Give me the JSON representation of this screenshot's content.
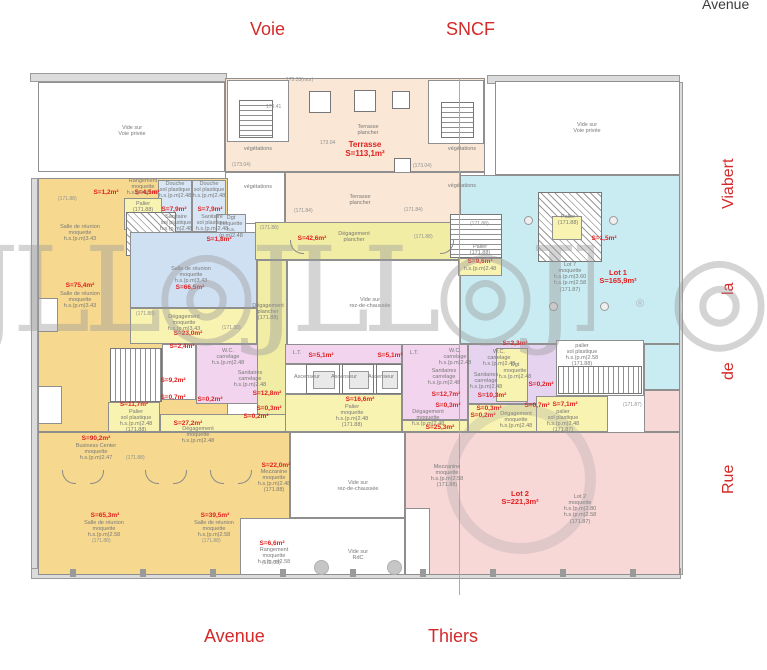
{
  "colors": {
    "accent_red": "#e01f1f",
    "street_red": "#d42a2a",
    "orange": "#f6d98e",
    "yellow": "#f8f3b0",
    "corridor_yellow": "#f1eda4",
    "blue": "#cfe0f3",
    "cyan": "#c9ecf2",
    "pink_lot2": "#f8d7d7",
    "magenta_sanitary": "#f2d4ee",
    "terrace_peach": "#fae7d5",
    "wall_gray": "#8f8f8f"
  },
  "streets": {
    "top_left": "Voie",
    "top_right": "SNCF",
    "top_far_right": "Avenue",
    "bottom_left": "Avenue",
    "bottom_right": "Thiers",
    "side_words": {
      "w1": "Viabert",
      "w2": "la",
      "w3": "de",
      "w4": "Rue"
    }
  },
  "watermark": {
    "row": "JLL◎JLL◎JLL◎",
    "fragment": "◎",
    "registered": "®"
  },
  "plan": {
    "area_labels": [
      {
        "lines": [
          "Terrasse",
          "S=113,1m²"
        ],
        "x": 335,
        "y": 141,
        "w": 60,
        "size": 8
      },
      {
        "lines": [
          "S=1,2m²"
        ],
        "x": 90,
        "y": 189,
        "w": 32
      },
      {
        "lines": [
          "S=4,5m²"
        ],
        "x": 131,
        "y": 189,
        "w": 32
      },
      {
        "lines": [
          "S=7,9m²"
        ],
        "x": 158,
        "y": 206,
        "w": 32
      },
      {
        "lines": [
          "S=7,9m²"
        ],
        "x": 194,
        "y": 206,
        "w": 32
      },
      {
        "lines": [
          "S=1,8m²"
        ],
        "x": 203,
        "y": 236,
        "w": 32
      },
      {
        "lines": [
          "S=66,5m²"
        ],
        "x": 168,
        "y": 284,
        "w": 44
      },
      {
        "lines": [
          "S=75,4m²"
        ],
        "x": 60,
        "y": 282,
        "w": 40
      },
      {
        "lines": [
          "S=42,6m²"
        ],
        "x": 292,
        "y": 235,
        "w": 40
      },
      {
        "lines": [
          "S=1,5m²"
        ],
        "x": 588,
        "y": 235,
        "w": 32
      },
      {
        "lines": [
          "Lot 1",
          "S=165,9m²"
        ],
        "x": 592,
        "y": 269,
        "w": 52,
        "size": 7.5
      },
      {
        "lines": [
          "S=9,6m²"
        ],
        "x": 462,
        "y": 258,
        "w": 36
      },
      {
        "lines": [
          "S=23,0m²"
        ],
        "x": 168,
        "y": 330,
        "w": 40
      },
      {
        "lines": [
          "S=2,4m²"
        ],
        "x": 166,
        "y": 343,
        "w": 32
      },
      {
        "lines": [
          "S=9,2m²"
        ],
        "x": 157,
        "y": 377,
        "w": 32
      },
      {
        "lines": [
          "S=0,7m²"
        ],
        "x": 157,
        "y": 394,
        "w": 32
      },
      {
        "lines": [
          "S=0,2m²"
        ],
        "x": 194,
        "y": 396,
        "w": 32
      },
      {
        "lines": [
          "S=12,8m²"
        ],
        "x": 247,
        "y": 390,
        "w": 40
      },
      {
        "lines": [
          "S=11,7m²"
        ],
        "x": 112,
        "y": 401,
        "w": 44
      },
      {
        "lines": [
          "S=27,2m²"
        ],
        "x": 166,
        "y": 420,
        "w": 44
      },
      {
        "lines": [
          "S=0,3m²"
        ],
        "x": 253,
        "y": 405,
        "w": 32
      },
      {
        "lines": [
          "S=0,2m²"
        ],
        "x": 240,
        "y": 413,
        "w": 32
      },
      {
        "lines": [
          "S=5,1m²"
        ],
        "x": 305,
        "y": 352,
        "w": 32
      },
      {
        "lines": [
          "S=5,1m²"
        ],
        "x": 374,
        "y": 352,
        "w": 32
      },
      {
        "lines": [
          "S=16,6m²"
        ],
        "x": 338,
        "y": 396,
        "w": 44
      },
      {
        "lines": [
          "S=12,7m²"
        ],
        "x": 424,
        "y": 391,
        "w": 44
      },
      {
        "lines": [
          "S=0,3m²"
        ],
        "x": 432,
        "y": 402,
        "w": 32
      },
      {
        "lines": [
          "S=25,3m²"
        ],
        "x": 418,
        "y": 424,
        "w": 44
      },
      {
        "lines": [
          "S=2,3m²"
        ],
        "x": 499,
        "y": 340,
        "w": 32
      },
      {
        "lines": [
          "S=10,3m²"
        ],
        "x": 470,
        "y": 392,
        "w": 44
      },
      {
        "lines": [
          "S=0,2m²"
        ],
        "x": 525,
        "y": 381,
        "w": 32
      },
      {
        "lines": [
          "S=0,7m²"
        ],
        "x": 521,
        "y": 402,
        "w": 32
      },
      {
        "lines": [
          "S=0,3m²"
        ],
        "x": 473,
        "y": 405,
        "w": 32
      },
      {
        "lines": [
          "S=0,2m²"
        ],
        "x": 467,
        "y": 412,
        "w": 32
      },
      {
        "lines": [
          "S=7,1m²"
        ],
        "x": 549,
        "y": 401,
        "w": 32
      },
      {
        "lines": [
          "S=90,2m²"
        ],
        "x": 74,
        "y": 435,
        "w": 44
      },
      {
        "lines": [
          "S=65,3m²"
        ],
        "x": 83,
        "y": 512,
        "w": 44
      },
      {
        "lines": [
          "S=39,5m²"
        ],
        "x": 193,
        "y": 512,
        "w": 44
      },
      {
        "lines": [
          "S=6,6m²"
        ],
        "x": 254,
        "y": 540,
        "w": 36
      },
      {
        "lines": [
          "S=22,0m²"
        ],
        "x": 254,
        "y": 462,
        "w": 44
      },
      {
        "lines": [
          "Lot 2",
          "S=221,3m²"
        ],
        "x": 492,
        "y": 490,
        "w": 56,
        "size": 7.5
      }
    ],
    "name_labels": [
      {
        "lines": [
          "Vide sur",
          "Voie privée"
        ],
        "x": 100,
        "y": 125,
        "w": 64
      },
      {
        "lines": [
          "Vide sur",
          "Voie privée"
        ],
        "x": 555,
        "y": 122,
        "w": 64
      },
      {
        "lines": [
          "Terrasse",
          "plancher"
        ],
        "x": 346,
        "y": 124,
        "w": 44
      },
      {
        "lines": [
          "végétations"
        ],
        "x": 238,
        "y": 146,
        "w": 40
      },
      {
        "lines": [
          "végétations"
        ],
        "x": 442,
        "y": 146,
        "w": 40
      },
      {
        "lines": [
          "végétations"
        ],
        "x": 238,
        "y": 184,
        "w": 40
      },
      {
        "lines": [
          "végétations"
        ],
        "x": 442,
        "y": 183,
        "w": 40
      },
      {
        "lines": [
          "Terrasse",
          "plancher"
        ],
        "x": 338,
        "y": 194,
        "w": 44
      },
      {
        "lines": [
          "Rangement",
          "moquette",
          "h.s.(p.m)2.67"
        ],
        "x": 122,
        "y": 178,
        "w": 42
      },
      {
        "lines": [
          "Douche",
          "sol plastique",
          "h.s.(p.m)2.48"
        ],
        "x": 157,
        "y": 181,
        "w": 36
      },
      {
        "lines": [
          "Douche",
          "sol plastique",
          "h.s.(p.m)2.48"
        ],
        "x": 191,
        "y": 181,
        "w": 36
      },
      {
        "lines": [
          "Sanitaire",
          "sol plastique",
          "h.s.(p.m)2.48"
        ],
        "x": 158,
        "y": 214,
        "w": 36
      },
      {
        "lines": [
          "Sanitaire",
          "sol plastique",
          "h.s.(p.m)2.48"
        ],
        "x": 194,
        "y": 214,
        "w": 36
      },
      {
        "lines": [
          "Palier",
          "(171.88)"
        ],
        "x": 128,
        "y": 201,
        "w": 30
      },
      {
        "lines": [
          "Dgt",
          "moquette",
          "h.s.(p.m)2.48"
        ],
        "x": 215,
        "y": 215,
        "w": 32
      },
      {
        "lines": [
          "Salle de réunion",
          "moquette",
          "h.s.(p.m)3.43"
        ],
        "x": 50,
        "y": 224,
        "w": 60
      },
      {
        "lines": [
          "Salle de réunion",
          "moquette",
          "h.s.(p.m)3.43"
        ],
        "x": 50,
        "y": 291,
        "w": 60
      },
      {
        "lines": [
          "Salle de réunion",
          "moquette",
          "h.s.(p.m)3.43"
        ],
        "x": 162,
        "y": 266,
        "w": 58
      },
      {
        "lines": [
          "Dégagement",
          "plancher"
        ],
        "x": 328,
        "y": 231,
        "w": 52
      },
      {
        "lines": [
          "Dégagement",
          "plancher",
          "(171.88)"
        ],
        "x": 248,
        "y": 303,
        "w": 40
      },
      {
        "lines": [
          "Vide sur",
          "rez-de-chaussée"
        ],
        "x": 342,
        "y": 297,
        "w": 56
      },
      {
        "lines": [
          "Lot 7",
          "moquette",
          "h.s.(p.m)3.60",
          "h.s.(p.m)2.58",
          "(171.87)"
        ],
        "x": 548,
        "y": 262,
        "w": 44
      },
      {
        "lines": [
          "Palier",
          "(171.88)"
        ],
        "x": 552,
        "y": 214,
        "w": 32
      },
      {
        "lines": [
          "Palier",
          "(171.88)"
        ],
        "x": 460,
        "y": 244,
        "w": 40
      },
      {
        "lines": [
          "h.s.(p.m)2.48"
        ],
        "x": 460,
        "y": 266,
        "w": 40
      },
      {
        "lines": [
          "Dégagement",
          "moquette",
          "h.s.(p.m)3.43"
        ],
        "x": 158,
        "y": 314,
        "w": 52
      },
      {
        "lines": [
          "W.C.",
          "carrelage",
          "h.s.(p.m)2.48"
        ],
        "x": 210,
        "y": 348,
        "w": 36
      },
      {
        "lines": [
          "Sanitaires",
          "carrelage",
          "h.s.(p.m)2.48"
        ],
        "x": 228,
        "y": 370,
        "w": 44
      },
      {
        "lines": [
          "W.C.",
          "carrelage",
          "h.s.(p.m)2.48"
        ],
        "x": 437,
        "y": 348,
        "w": 36
      },
      {
        "lines": [
          "Sanitaires",
          "carrelage",
          "h.s.(p.m)2.48"
        ],
        "x": 422,
        "y": 368,
        "w": 44
      },
      {
        "lines": [
          "W.C.",
          "carrelage",
          "h.s.(p.m)2.48"
        ],
        "x": 481,
        "y": 349,
        "w": 36
      },
      {
        "lines": [
          "Sanitaires",
          "carrelage",
          "h.s.(p.m)2.48"
        ],
        "x": 464,
        "y": 372,
        "w": 44
      },
      {
        "lines": [
          "Palier",
          "sol plastique",
          "h.s.(p.m)2.48",
          "(171.88)"
        ],
        "x": 112,
        "y": 409,
        "w": 48
      },
      {
        "lines": [
          "Dégagement",
          "moquette",
          "h.s.(p.m)2.48"
        ],
        "x": 176,
        "y": 426,
        "w": 44
      },
      {
        "lines": [
          "Ascenseur"
        ],
        "x": 288,
        "y": 374,
        "w": 38
      },
      {
        "lines": [
          "Ascenseur"
        ],
        "x": 325,
        "y": 374,
        "w": 38
      },
      {
        "lines": [
          "Ascenseur"
        ],
        "x": 362,
        "y": 374,
        "w": 38
      },
      {
        "lines": [
          "L.T."
        ],
        "x": 288,
        "y": 350,
        "w": 18
      },
      {
        "lines": [
          "L.T."
        ],
        "x": 405,
        "y": 350,
        "w": 18
      },
      {
        "lines": [
          "Palier",
          "moquette",
          "h.s.(p.m)2.48",
          "(171.88)"
        ],
        "x": 328,
        "y": 404,
        "w": 48
      },
      {
        "lines": [
          "Dgt",
          "moquette",
          "h.s.(p.m)2.48"
        ],
        "x": 498,
        "y": 362,
        "w": 34
      },
      {
        "lines": [
          "Dégagement",
          "moquette",
          "h.s.(p.m)2.48"
        ],
        "x": 492,
        "y": 411,
        "w": 48
      },
      {
        "lines": [
          "Dégagement",
          "moquette",
          "h.s.(p.m)2.48"
        ],
        "x": 404,
        "y": 409,
        "w": 48
      },
      {
        "lines": [
          "palier",
          "sol plastique",
          "h.s.(p.m)2.58",
          "(171.88)"
        ],
        "x": 560,
        "y": 343,
        "w": 44
      },
      {
        "lines": [
          "palier",
          "sol plastique",
          "h.s.(p.m)2.48",
          "(171.87)"
        ],
        "x": 541,
        "y": 409,
        "w": 44
      },
      {
        "lines": [
          "Business Center",
          "moquette",
          "h.s.(p.m)2.47"
        ],
        "x": 64,
        "y": 443,
        "w": 64
      },
      {
        "lines": [
          "Salle de réunion",
          "moquette",
          "h.s.(p.m)2.58"
        ],
        "x": 74,
        "y": 520,
        "w": 60
      },
      {
        "lines": [
          "Salle de réunion",
          "moquette",
          "h.s.(p.m)2.58"
        ],
        "x": 184,
        "y": 520,
        "w": 60
      },
      {
        "lines": [
          "Rangement",
          "moquette",
          "h.s.(p.m)2.58"
        ],
        "x": 248,
        "y": 547,
        "w": 52
      },
      {
        "lines": [
          "Mezzanine",
          "moquette",
          "h.s.(p.m)2.48",
          "(171.88)"
        ],
        "x": 248,
        "y": 469,
        "w": 52
      },
      {
        "lines": [
          "Mezzanine",
          "moquette",
          "h.s.(p.m)2.58",
          "(171.88)"
        ],
        "x": 421,
        "y": 464,
        "w": 52
      },
      {
        "lines": [
          "Lot 2",
          "moquette",
          "h.s.(p.m)2.80",
          "h.s.(p.m)2.58",
          "(171.87)"
        ],
        "x": 556,
        "y": 494,
        "w": 48
      },
      {
        "lines": [
          "Vide sur",
          "rez-de-chaussée"
        ],
        "x": 330,
        "y": 480,
        "w": 56
      },
      {
        "lines": [
          "Vide sur",
          "RdC"
        ],
        "x": 336,
        "y": 549,
        "w": 44
      }
    ],
    "elevation_labels": [
      {
        "t": "175.33(mur)",
        "x": 286,
        "y": 78
      },
      {
        "t": "173.41",
        "x": 266,
        "y": 105
      },
      {
        "t": "(173.04)",
        "x": 232,
        "y": 163
      },
      {
        "t": "173.04",
        "x": 320,
        "y": 141
      },
      {
        "t": "(173.04)",
        "x": 413,
        "y": 164
      },
      {
        "t": "(171.84)",
        "x": 294,
        "y": 209
      },
      {
        "t": "(171.84)",
        "x": 404,
        "y": 208
      },
      {
        "t": "(171.88)",
        "x": 58,
        "y": 197
      },
      {
        "t": "(171.88)",
        "x": 260,
        "y": 226
      },
      {
        "t": "(171.88)",
        "x": 414,
        "y": 235
      },
      {
        "t": "(171.88)",
        "x": 136,
        "y": 312
      },
      {
        "t": "(171.88)",
        "x": 222,
        "y": 326
      },
      {
        "t": "(171.88)",
        "x": 126,
        "y": 456
      },
      {
        "t": "(171.88)",
        "x": 92,
        "y": 539
      },
      {
        "t": "(171.88)",
        "x": 202,
        "y": 539
      },
      {
        "t": "(171.88)",
        "x": 262,
        "y": 561
      },
      {
        "t": "(171.87)",
        "x": 623,
        "y": 403
      },
      {
        "t": "(171.88)",
        "x": 470,
        "y": 222
      }
    ]
  }
}
